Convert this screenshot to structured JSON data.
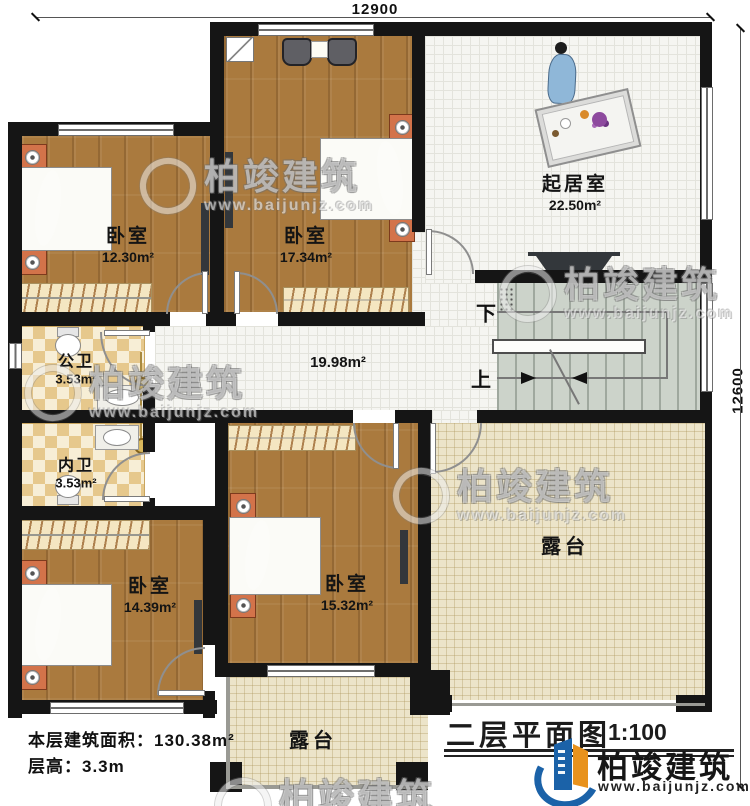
{
  "dimensions": {
    "top": "12900",
    "right": "12600"
  },
  "rooms": {
    "bedroom_tl": {
      "name": "卧室",
      "area": "12.30m²"
    },
    "bedroom_tm": {
      "name": "卧室",
      "area": "17.34m²"
    },
    "living": {
      "name": "起居室",
      "area": "22.50m²"
    },
    "bath_public": {
      "name": "公卫",
      "area": "3.53m²"
    },
    "bath_private": {
      "name": "内卫",
      "area": "3.53m²"
    },
    "bedroom_bl": {
      "name": "卧室",
      "area": "14.39m²"
    },
    "bedroom_bm": {
      "name": "卧室",
      "area": "15.32m²"
    },
    "hallway": {
      "area": "19.98m²"
    },
    "terrace_right": {
      "name": "露台"
    },
    "terrace_bottom": {
      "name": "露台"
    }
  },
  "stairs": {
    "down_label": "下",
    "up_label": "上"
  },
  "info": {
    "floor_area": "本层建筑面积：130.38m²",
    "floor_height": "层高：3.3m"
  },
  "title": {
    "plan_name": "二层平面图",
    "scale": "1:100"
  },
  "brand": {
    "name": "柏竣建筑",
    "website": "www.baijunjz.com"
  },
  "colors": {
    "wall": "#151515",
    "wood_floor": "#aa7a3e",
    "bed": "#7cbad3",
    "terrace": "#ece4c9",
    "stairs": "#ccd3ca",
    "logo_blue": "#1b62a8",
    "logo_orange": "#e8921d"
  }
}
